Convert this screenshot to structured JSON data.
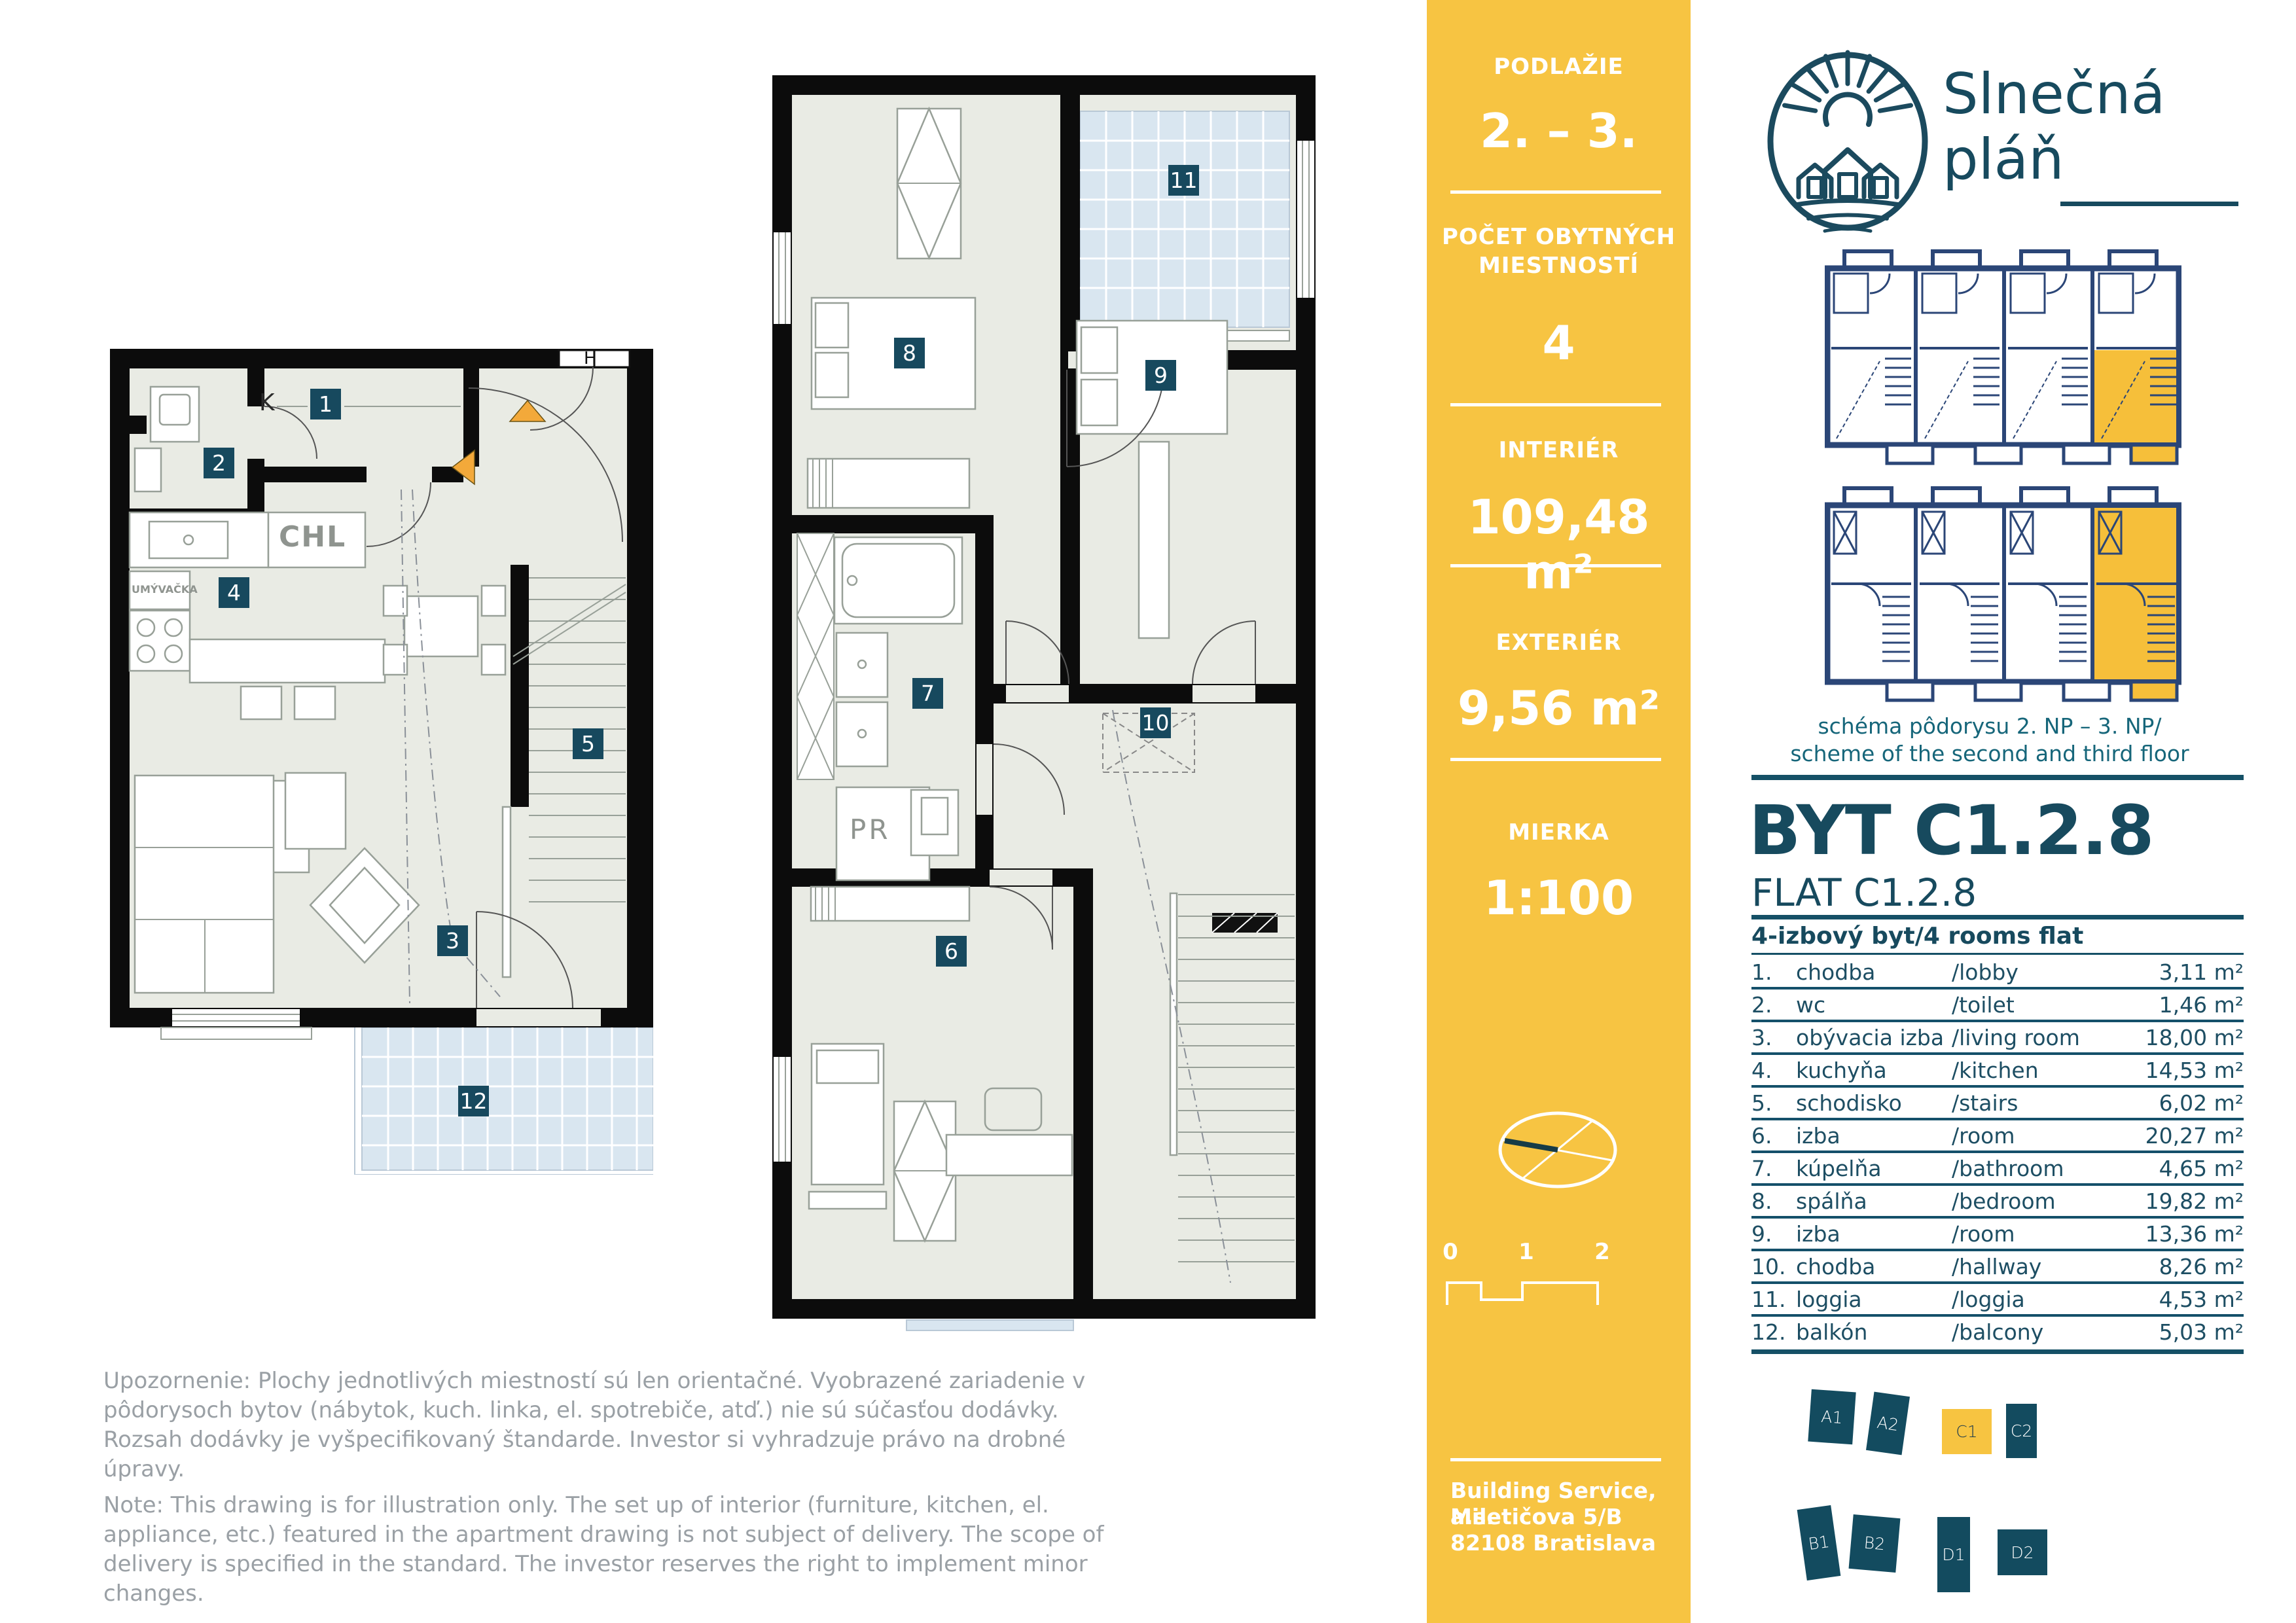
{
  "brand": {
    "line1": "Slnečná",
    "line2": "pláň",
    "logo_icon": "sun-over-houses-icon"
  },
  "band": {
    "floor_label": "PODLAŽIE",
    "floor_value": "2. – 3.",
    "rooms_label1": "POČET OBYTNÝCH",
    "rooms_label2": "MIESTNOSTÍ",
    "rooms_value": "4",
    "interior_label": "INTERIÉR",
    "interior_value": "109,48 m²",
    "exterior_label": "EXTERIÉR",
    "exterior_value": "9,56 m²",
    "scale_label": "MIERKA",
    "scale_value": "1:100",
    "bar0": "0",
    "bar1": "1",
    "bar2": "2",
    "address1": "Building Service, a.s.",
    "address2": "Miletičova 5/B",
    "address3": "82108 Bratislava"
  },
  "scheme": {
    "caption1": "schéma pôdorysu 2. NP – 3. NP/",
    "caption2": "scheme of the second and third floor"
  },
  "flat": {
    "title": "BYT C1.2.8",
    "subtitle": "FLAT C1.2.8",
    "table_title": "4-izbový byt/4 rooms flat",
    "rooms": [
      {
        "num": "1.",
        "sk": "chodba",
        "en": "/lobby",
        "area": "3,11 m²"
      },
      {
        "num": "2.",
        "sk": "wc",
        "en": "/toilet",
        "area": "1,46 m²"
      },
      {
        "num": "3.",
        "sk": "obývacia izba",
        "en": "/living room",
        "area": "18,00 m²"
      },
      {
        "num": "4.",
        "sk": "kuchyňa",
        "en": "/kitchen",
        "area": "14,53 m²"
      },
      {
        "num": "5.",
        "sk": "schodisko",
        "en": "/stairs",
        "area": "6,02 m²"
      },
      {
        "num": "6.",
        "sk": "izba",
        "en": "/room",
        "area": "20,27 m²"
      },
      {
        "num": "7.",
        "sk": "kúpelňa",
        "en": "/bathroom",
        "area": "4,65 m²"
      },
      {
        "num": "8.",
        "sk": "spálňa",
        "en": "/bedroom",
        "area": "19,82 m²"
      },
      {
        "num": "9.",
        "sk": "izba",
        "en": "/room",
        "area": "13,36 m²"
      },
      {
        "num": "10.",
        "sk": "chodba",
        "en": "/hallway",
        "area": "8,26 m²"
      },
      {
        "num": "11.",
        "sk": "loggia",
        "en": "/loggia",
        "area": "4,53 m²"
      },
      {
        "num": "12.",
        "sk": "balkón",
        "en": "/balcony",
        "area": "5,03 m²"
      }
    ]
  },
  "plans": {
    "badges": {
      "b1": "1",
      "b2": "2",
      "b3": "3",
      "b4": "4",
      "b5": "5",
      "b6": "6",
      "b7": "7",
      "b8": "8",
      "b9": "9",
      "b10": "10",
      "b11": "11",
      "b12": "12"
    },
    "labels": {
      "k": "K",
      "chl": "CHL",
      "umyvacka": "UMÝVAČKA",
      "pr": "PR",
      "h": "H"
    }
  },
  "site": {
    "blocks": [
      {
        "label": "A1"
      },
      {
        "label": "A2"
      },
      {
        "label": "C1"
      },
      {
        "label": "C2"
      },
      {
        "label": "B1"
      },
      {
        "label": "B2"
      },
      {
        "label": "D1"
      },
      {
        "label": "D2"
      }
    ]
  },
  "disclaimer": {
    "sk": "Upozornenie: Plochy jednotlivých miestností sú len orientačné. Vyobrazené zariadenie v pôdorysoch bytov (nábytok, kuch. linka, el. spotrebiče, atď.) nie sú súčasťou dodávky. Rozsah dodávky je vyšpecifikovaný štandarde. Investor si vyhradzuje právo na drobné úpravy.",
    "en": "Note: This drawing is for illustration only. The set up of interior (furniture, kitchen, el. appliance, etc.) featured in the apartment drawing is not subject of delivery. The scope of delivery is specified in the standard. The investor reserves the right to implement minor changes."
  },
  "colors": {
    "accent_yellow": "#f7c442",
    "teal": "#174a5e",
    "schematic_navy": "#2b4677",
    "floor": "#e9ebe4",
    "balcony_blue": "#d9e6f0",
    "triangle_orange": "#f3a93a"
  }
}
